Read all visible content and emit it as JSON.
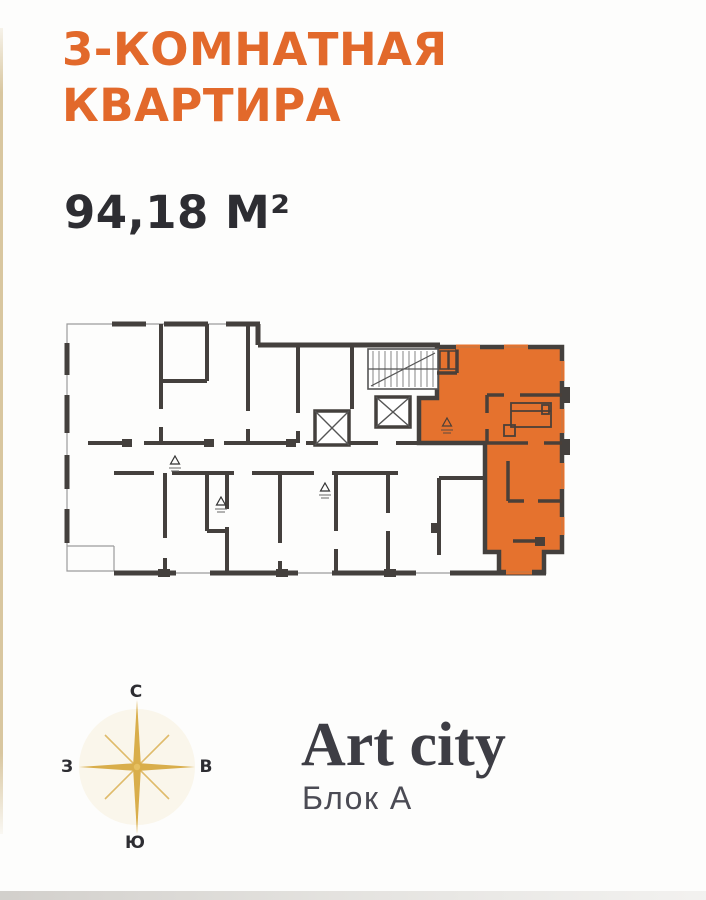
{
  "header": {
    "title_line1": "3-КОМНАТНАЯ",
    "title_line2": "КВАРТИРА",
    "area": "94,18 М²"
  },
  "compass": {
    "north": "С",
    "south": "Ю",
    "west": "З",
    "east": "В"
  },
  "brand": {
    "name": "Art city",
    "block": "Блок А"
  },
  "colors": {
    "title_orange": "#E2692B",
    "dark_text": "#2D2D32",
    "apartment_fill": "#E5722E",
    "wall_dark": "#44403D",
    "wall_inner_orange": "#4A3F38",
    "gold": "#D9AE4B",
    "brand_dark": "#3D3D44",
    "brand_sub": "#4B4B54",
    "accent_line": "#D9C7A0"
  }
}
